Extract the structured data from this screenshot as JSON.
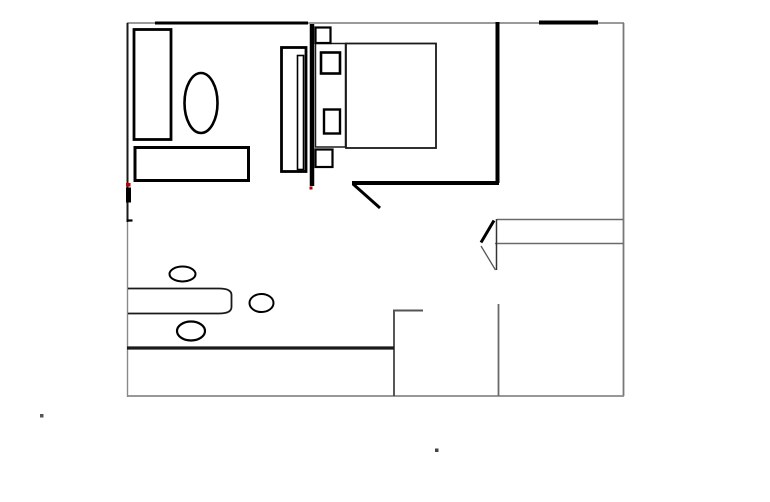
{
  "canvas": {
    "width": 770,
    "height": 502,
    "background": "#ffffff"
  },
  "palette": {
    "wall_gray": "#787878",
    "ink_black": "#000000",
    "mid_gray": "#555555",
    "accent_red": "#c00000"
  },
  "floorplan": {
    "groups": [
      {
        "name": "outer-walls",
        "shapes": [
          {
            "name": "outer-wall-top",
            "type": "line",
            "attrs": {
              "x1": 127,
              "y1": 23,
              "x2": 624,
              "y2": 23,
              "stroke": "#787878",
              "stroke-width": 1.6
            }
          },
          {
            "name": "outer-wall-left-upper",
            "type": "line",
            "attrs": {
              "x1": 127.5,
              "y1": 23,
              "x2": 127.5,
              "y2": 222,
              "stroke": "#1a1a1a",
              "stroke-width": 2
            }
          },
          {
            "name": "outer-wall-left-lower",
            "type": "line",
            "attrs": {
              "x1": 127.5,
              "y1": 222,
              "x2": 127.5,
              "y2": 397,
              "stroke": "#8a8a8a",
              "stroke-width": 1.4
            }
          },
          {
            "name": "outer-wall-right",
            "type": "line",
            "attrs": {
              "x1": 623.5,
              "y1": 23,
              "x2": 623.5,
              "y2": 396,
              "stroke": "#787878",
              "stroke-width": 1.8
            }
          },
          {
            "name": "outer-wall-bottom",
            "type": "line",
            "attrs": {
              "x1": 127,
              "y1": 396,
              "x2": 624,
              "y2": 396,
              "stroke": "#8a8a8a",
              "stroke-width": 1.8
            }
          },
          {
            "name": "top-wall-thick-segment-left",
            "type": "line",
            "attrs": {
              "x1": 155,
              "y1": 23,
              "x2": 308,
              "y2": 23,
              "stroke": "#000000",
              "stroke-width": 3
            }
          },
          {
            "name": "top-wall-thick-segment-right",
            "type": "line",
            "attrs": {
              "x1": 539,
              "y1": 22.5,
              "x2": 598,
              "y2": 22.5,
              "stroke": "#000000",
              "stroke-width": 4
            }
          }
        ]
      },
      {
        "name": "interior-walls",
        "shapes": [
          {
            "name": "closet-wall-vertical",
            "type": "line",
            "attrs": {
              "x1": 312,
              "y1": 24,
              "x2": 312,
              "y2": 186,
              "stroke": "#000000",
              "stroke-width": 4.5
            }
          },
          {
            "name": "entry-wall-vertical",
            "type": "line",
            "attrs": {
              "x1": 497.5,
              "y1": 22,
              "x2": 497.5,
              "y2": 183,
              "stroke": "#000000",
              "stroke-width": 4
            }
          },
          {
            "name": "entry-wall-horizontal",
            "type": "line",
            "attrs": {
              "x1": 352,
              "y1": 183,
              "x2": 499,
              "y2": 183,
              "stroke": "#000000",
              "stroke-width": 4
            }
          },
          {
            "name": "door-swing-diagonal",
            "type": "line",
            "attrs": {
              "x1": 353,
              "y1": 184,
              "x2": 380,
              "y2": 208,
              "stroke": "#000000",
              "stroke-width": 3
            }
          },
          {
            "name": "hallway-line-top",
            "type": "line",
            "attrs": {
              "x1": 497,
              "y1": 219.5,
              "x2": 623,
              "y2": 219.5,
              "stroke": "#6a6a6a",
              "stroke-width": 1.5
            }
          },
          {
            "name": "hallway-line-bottom",
            "type": "line",
            "attrs": {
              "x1": 495,
              "y1": 243.5,
              "x2": 623.5,
              "y2": 243.5,
              "stroke": "#6a6a6a",
              "stroke-width": 1.5
            }
          },
          {
            "name": "partition-vertical-right",
            "type": "line",
            "attrs": {
              "x1": 498.5,
              "y1": 304,
              "x2": 498.5,
              "y2": 396,
              "stroke": "#6a6a6a",
              "stroke-width": 1.8
            }
          },
          {
            "name": "partition-vertical-mid",
            "type": "line",
            "attrs": {
              "x1": 394,
              "y1": 310,
              "x2": 394,
              "y2": 396,
              "stroke": "#444444",
              "stroke-width": 1.8
            }
          },
          {
            "name": "partition-step-horizontal",
            "type": "line",
            "attrs": {
              "x1": 393,
              "y1": 310.5,
              "x2": 423,
              "y2": 310.5,
              "stroke": "#555555",
              "stroke-width": 2
            }
          },
          {
            "name": "counter-edge-thick",
            "type": "line",
            "attrs": {
              "x1": 127,
              "y1": 348,
              "x2": 394,
              "y2": 348,
              "stroke": "#1a1a1a",
              "stroke-width": 3.2
            }
          }
        ]
      },
      {
        "name": "door-arrow",
        "shapes": [
          {
            "name": "arrow-spine-vertical",
            "type": "line",
            "attrs": {
              "x1": 496.5,
              "y1": 219,
              "x2": 496.5,
              "y2": 270,
              "stroke": "#333333",
              "stroke-width": 1.5
            }
          },
          {
            "name": "arrow-upper-diagonal-thick",
            "type": "line",
            "attrs": {
              "x1": 481,
              "y1": 242.5,
              "x2": 494,
              "y2": 220.5,
              "stroke": "#000000",
              "stroke-width": 3
            }
          },
          {
            "name": "arrow-lower-diagonal-thin",
            "type": "line",
            "attrs": {
              "x1": 481,
              "y1": 246,
              "x2": 495.5,
              "y2": 270,
              "stroke": "#555555",
              "stroke-width": 1.3
            }
          }
        ]
      },
      {
        "name": "furniture",
        "shapes": [
          {
            "name": "wardrobe",
            "type": "rect",
            "attrs": {
              "x": 134,
              "y": 29.5,
              "width": 37,
              "height": 110,
              "stroke": "#000000",
              "stroke-width": 2.8
            }
          },
          {
            "name": "oval-chair",
            "type": "ellipse",
            "attrs": {
              "cx": 201,
              "cy": 103,
              "rx": 16.5,
              "ry": 30,
              "stroke": "#000000",
              "stroke-width": 2.6
            }
          },
          {
            "name": "dresser",
            "type": "rect",
            "attrs": {
              "x": 135,
              "y": 147.5,
              "width": 113.5,
              "height": 33,
              "stroke": "#000000",
              "stroke-width": 3
            }
          },
          {
            "name": "bed-headboard",
            "type": "rect",
            "attrs": {
              "x": 281.5,
              "y": 47.5,
              "width": 24.5,
              "height": 124,
              "stroke": "#000000",
              "stroke-width": 2.8
            }
          },
          {
            "name": "headboard-slat",
            "type": "rect",
            "attrs": {
              "x": 297.5,
              "y": 55.5,
              "width": 6,
              "height": 114,
              "stroke": "#000000",
              "stroke-width": 1.6
            }
          },
          {
            "name": "bed-pillow-strip",
            "type": "rect",
            "attrs": {
              "x": 315.5,
              "y": 43.5,
              "width": 30,
              "height": 103.5,
              "stroke": "#1a1a1a",
              "stroke-width": 1.5
            }
          },
          {
            "name": "bed-mattress",
            "type": "rect",
            "attrs": {
              "x": 346,
              "y": 43.5,
              "width": 90,
              "height": 104.5,
              "stroke": "#1a1a1a",
              "stroke-width": 1.8
            }
          },
          {
            "name": "pillow-top",
            "type": "rect",
            "attrs": {
              "x": 321,
              "y": 52.5,
              "width": 19,
              "height": 21,
              "stroke": "#000000",
              "stroke-width": 2.6
            }
          },
          {
            "name": "pillow-bottom",
            "type": "rect",
            "attrs": {
              "x": 324,
              "y": 109.5,
              "width": 16,
              "height": 24,
              "stroke": "#000000",
              "stroke-width": 2.4
            }
          },
          {
            "name": "bedpost-top-square",
            "type": "rect",
            "attrs": {
              "x": 315.5,
              "y": 27.5,
              "width": 15,
              "height": 15.5,
              "stroke": "#000000",
              "stroke-width": 2.2
            }
          },
          {
            "name": "bedpost-bottom-square",
            "type": "rect",
            "attrs": {
              "x": 315.5,
              "y": 149.5,
              "width": 17,
              "height": 17.5,
              "stroke": "#000000",
              "stroke-width": 2.2
            }
          },
          {
            "name": "bench-rounded",
            "type": "path",
            "attrs": {
              "d": "M128,288.5 H219 Q231.5,288.5 231.5,295 V307 Q231.5,313.5 219,313.5 H128",
              "stroke": "#1a1a1a",
              "stroke-width": 1.8
            }
          },
          {
            "name": "stool-oval-1",
            "type": "ellipse",
            "attrs": {
              "cx": 182.5,
              "cy": 274,
              "rx": 13,
              "ry": 7.5,
              "stroke": "#000000",
              "stroke-width": 2
            }
          },
          {
            "name": "stool-oval-2",
            "type": "ellipse",
            "attrs": {
              "cx": 261.5,
              "cy": 303,
              "rx": 12,
              "ry": 9,
              "stroke": "#000000",
              "stroke-width": 2
            }
          },
          {
            "name": "stool-oval-3",
            "type": "ellipse",
            "attrs": {
              "cx": 191,
              "cy": 331,
              "rx": 14,
              "ry": 9.5,
              "stroke": "#000000",
              "stroke-width": 2.2
            }
          }
        ]
      },
      {
        "name": "marks",
        "shapes": [
          {
            "name": "red-mark-left-wall",
            "type": "rect",
            "attrs": {
              "x": 126,
              "y": 183,
              "width": 4.5,
              "height": 3.5,
              "fill": "#c00000"
            }
          },
          {
            "name": "hinge-blob-left-wall",
            "type": "rect",
            "attrs": {
              "x": 126,
              "y": 187.5,
              "width": 5,
              "height": 15,
              "fill": "#000000"
            }
          },
          {
            "name": "tick-left-wall",
            "type": "line",
            "attrs": {
              "x1": 126.5,
              "y1": 220.5,
              "x2": 132.5,
              "y2": 220.5,
              "stroke": "#000000",
              "stroke-width": 2.2
            }
          },
          {
            "name": "red-dot-door",
            "type": "rect",
            "attrs": {
              "x": 309.5,
              "y": 186.5,
              "width": 3,
              "height": 3,
              "fill": "#b00000"
            }
          },
          {
            "name": "stray-dot-left",
            "type": "rect",
            "attrs": {
              "x": 40,
              "y": 414,
              "width": 3.5,
              "height": 3.5,
              "fill": "#555555"
            }
          },
          {
            "name": "stray-dot-bottom",
            "type": "rect",
            "attrs": {
              "x": 435,
              "y": 448.5,
              "width": 3.5,
              "height": 3.5,
              "fill": "#444444"
            }
          }
        ]
      }
    ]
  }
}
